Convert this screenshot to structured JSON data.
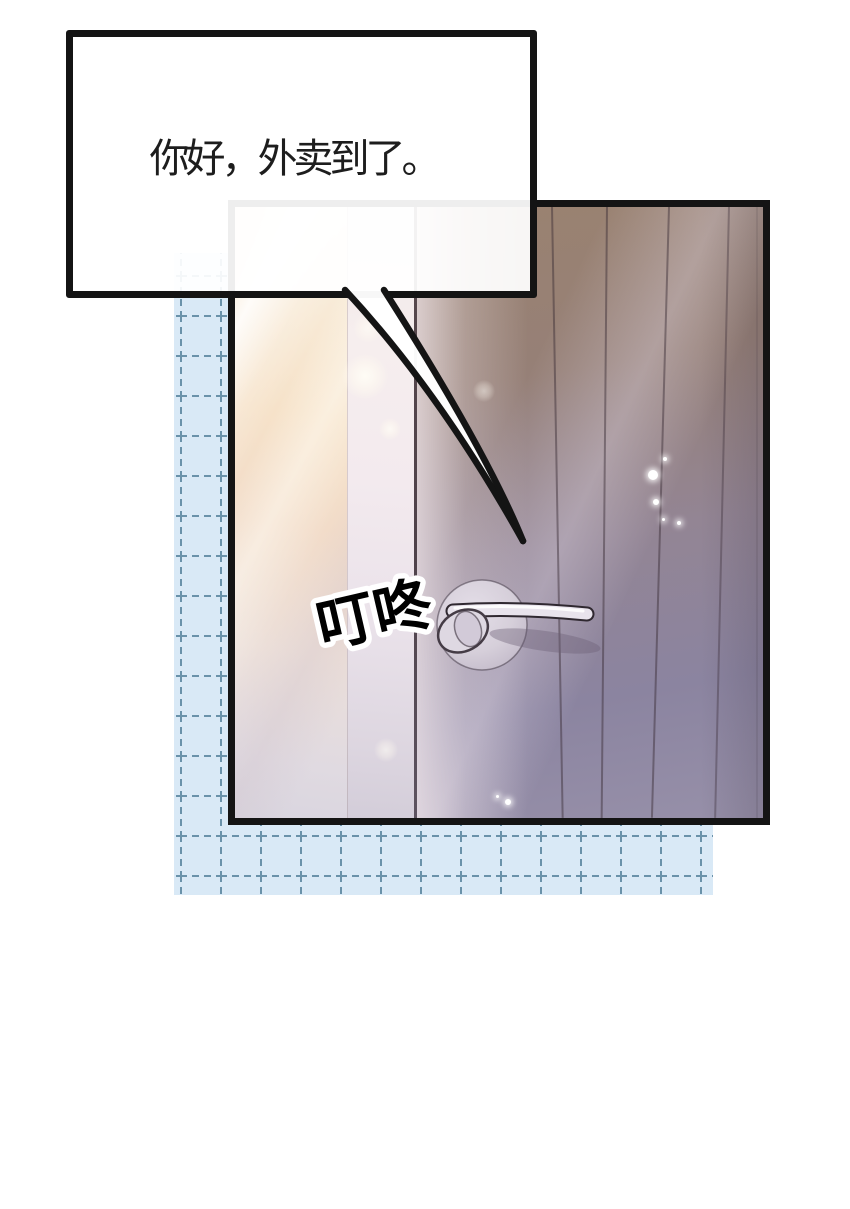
{
  "speech_bubble": {
    "text": "你好，外卖到了。",
    "text_color": "#1d1d1d",
    "fill": "#ffffff",
    "border_color": "#141414"
  },
  "sfx": {
    "text": "叮咚",
    "fill": "#000000",
    "outline": "#ffffff"
  },
  "colors": {
    "page_background": "#ffffff",
    "grid_background": "#d9e9f6",
    "grid_line": "#6a92aa",
    "panel_outline": "#141414",
    "door_warm_brown": "#9a8170",
    "door_mauve": "#8e86a0",
    "wall_light_peach": "#f4dcc3",
    "handle_metal": "#e8e3ec"
  }
}
